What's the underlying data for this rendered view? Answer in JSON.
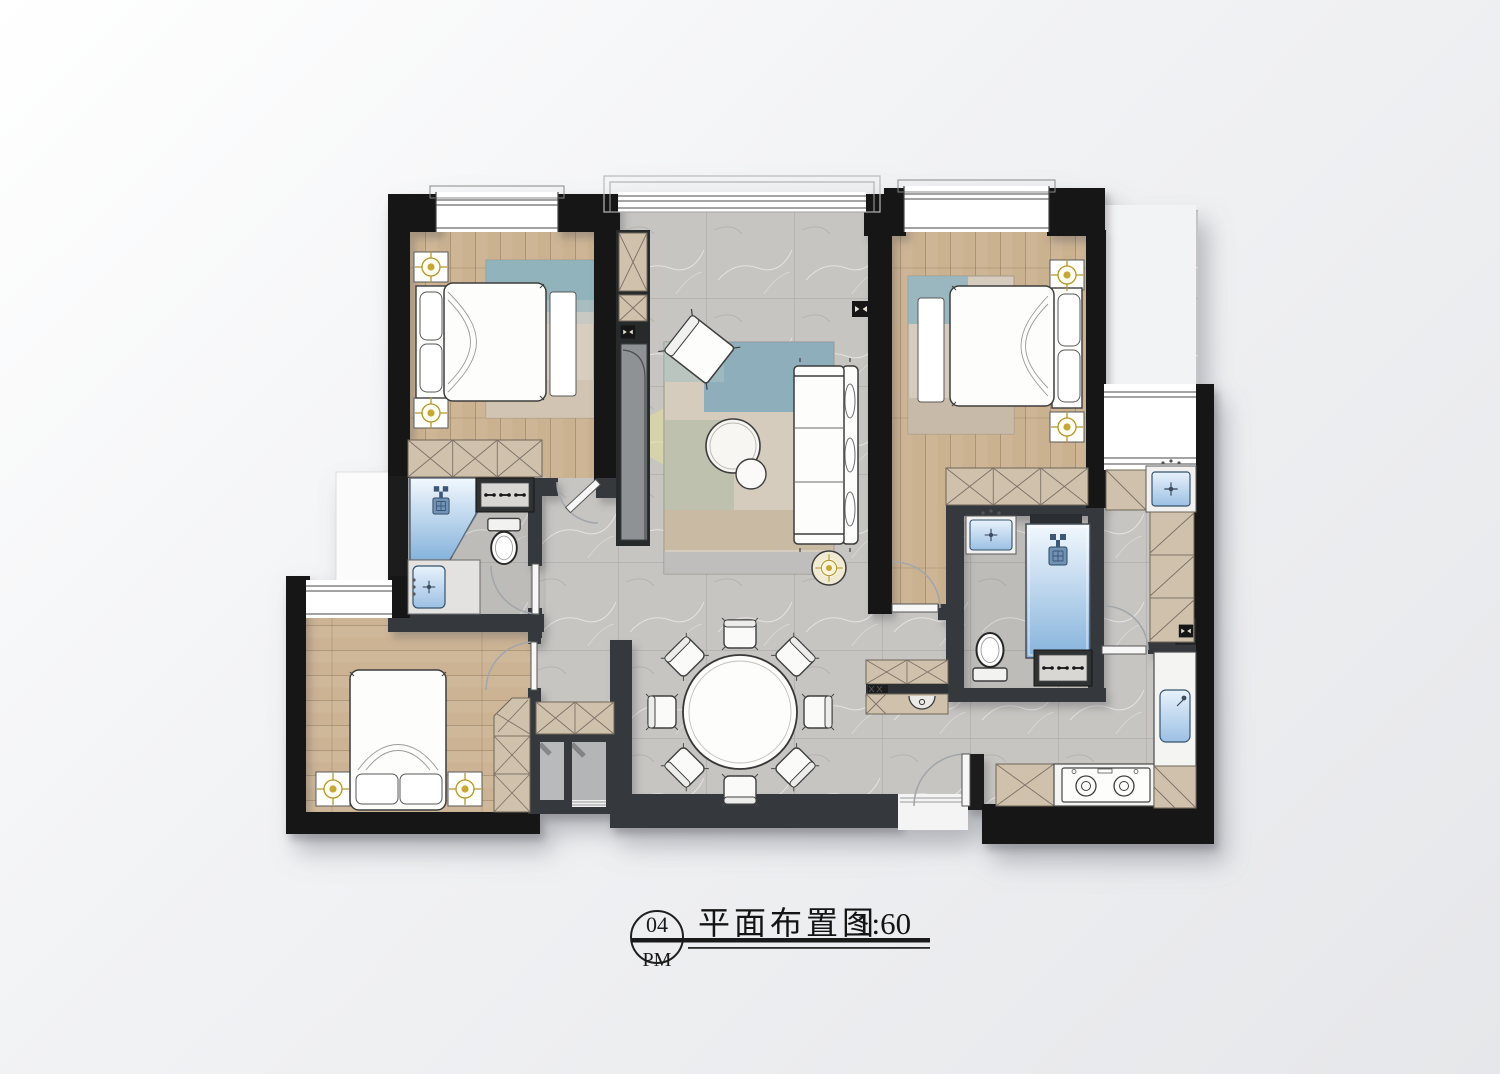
{
  "title_block": {
    "sheet_number": "04",
    "sheet_label": "PM",
    "drawing_title": "平面布置图",
    "scale": "1:60"
  },
  "drawing": {
    "type": "residential floor plan, top view, rendered",
    "rooms": [
      "bedroom-top-left",
      "living-room",
      "master-bedroom-top-right",
      "bathroom-left",
      "hallway",
      "bedroom-bottom-left",
      "dining-area",
      "master-bathroom",
      "utility-corridor",
      "kitchen",
      "entry"
    ],
    "furniture_icons": [
      "double-bed",
      "nightstand",
      "ceiling-light",
      "wardrobe-x-cabinet",
      "area-rug",
      "bench",
      "sofa-3-seat",
      "accent-chair",
      "round-coffee-table",
      "floor-lamp",
      "projector-light-cone",
      "round-dining-table",
      "dining-chair",
      "sideboard-with-washbasin",
      "toilet",
      "wash-basin",
      "shower",
      "vanity-cabinet",
      "gas-stove",
      "kitchen-sink",
      "laundry-sink",
      "wall-socket",
      "door-swing",
      "bay-window"
    ]
  },
  "palette": {
    "background": "#eceef0",
    "wall_black": "#161616",
    "wall_charcoal": "#36393c",
    "wood_floor": "#cab190",
    "tile_floor": "#c7c5c2",
    "cabinet_beige": "#d0c1ad",
    "water_blue": "#86b3dc",
    "gold_accent": "#b5952f",
    "light_cone_yellow": "#e5e08f",
    "furniture_white": "#fdfdfc"
  }
}
